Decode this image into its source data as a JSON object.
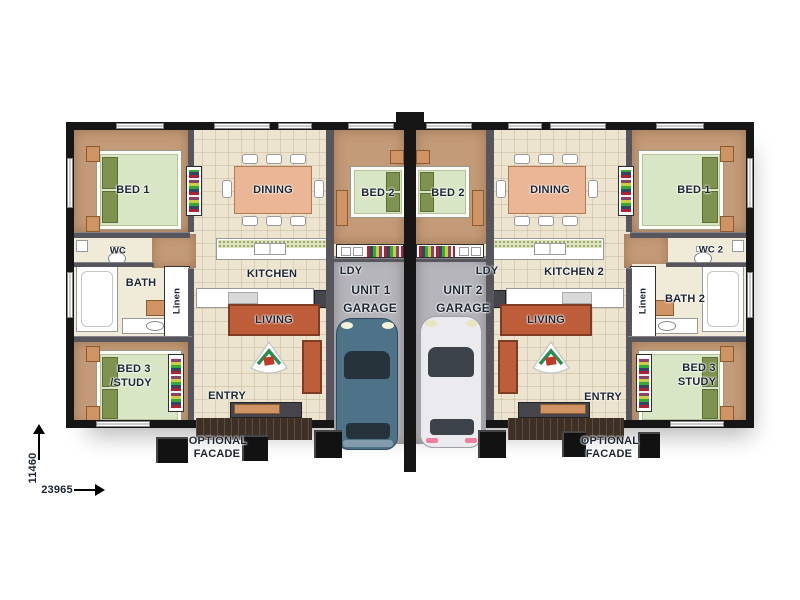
{
  "plan": {
    "unit1": {
      "bed1": "BED 1",
      "wc": "WC",
      "bath": "BATH",
      "linen": "Linen",
      "bed3_line1": "BED 3",
      "bed3_line2": "/STUDY",
      "dining": "DINING",
      "kitchen": "KITCHEN",
      "living": "LIVING",
      "entry": "ENTRY",
      "bed2": "BED 2",
      "ldy": "LDY",
      "unit_label": "UNIT 1",
      "garage": "GARAGE",
      "facade_line1": "OPTIONAL",
      "facade_line2": "FACADE"
    },
    "unit2": {
      "bed1": "BED 1",
      "wc": "WC 2",
      "bath": "BATH 2",
      "linen": "Linen",
      "bed3_line1": "BED 3",
      "bed3_line2": "STUDY",
      "dining": "DINING",
      "kitchen": "KITCHEN 2",
      "living": "LIVING",
      "entry": "ENTRY",
      "bed2": "BED 2",
      "ldy": "LDY",
      "unit_label": "UNIT 2",
      "garage": "GARAGE",
      "facade_line1": "OPTIONAL",
      "facade_line2": "FACADE"
    },
    "dimensions": {
      "depth_label": "11460",
      "width_label": "23965"
    },
    "colors": {
      "tile": "#ece4cf",
      "carpet": "#c49b78",
      "garage": "#b5b5bb",
      "wallx": "#161616",
      "walli": "#56565c",
      "bath": "#f0ead9",
      "mattress": "#d9e6c5",
      "pillow": "#7e9350",
      "orange": "#cf9364",
      "sofa": "#bd5d39",
      "carblue": "#4e7287",
      "carwhite": "#ebebef",
      "label": "#1d2531",
      "porch": "#3f3026"
    }
  }
}
